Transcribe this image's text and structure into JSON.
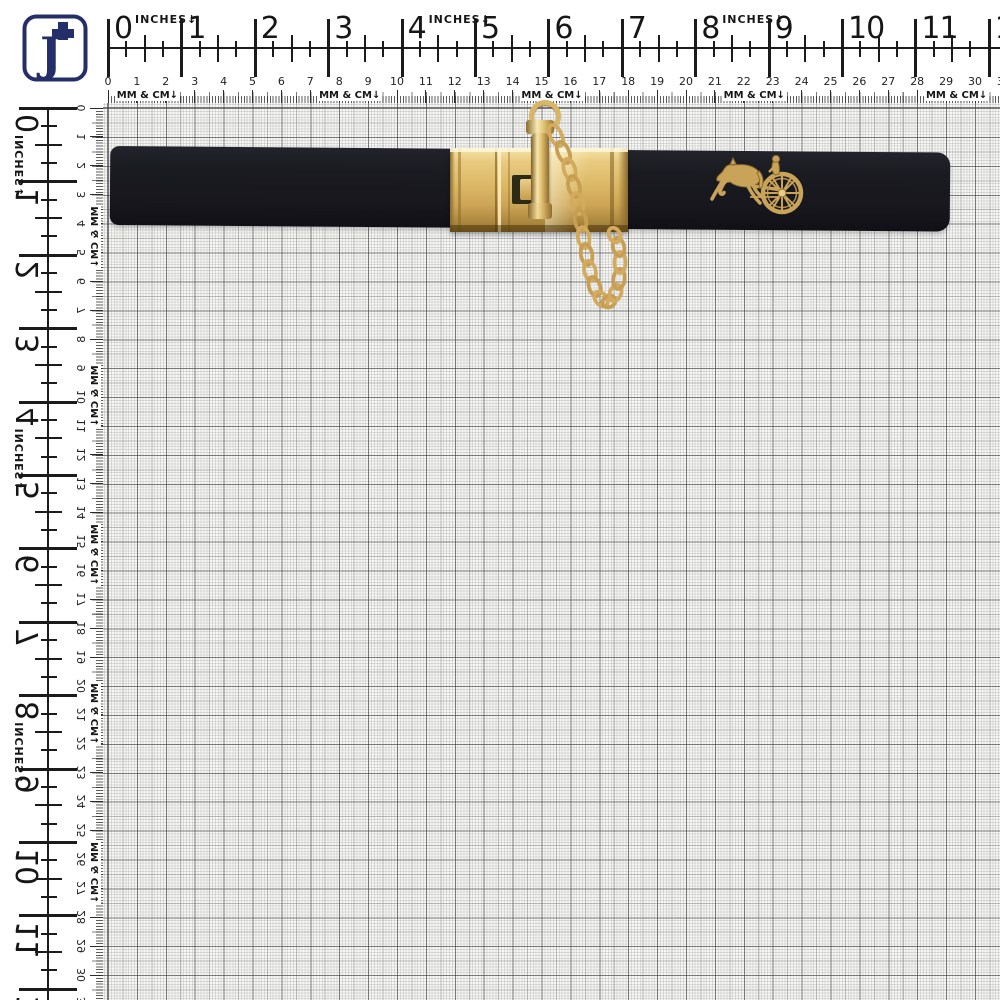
{
  "window": {
    "width": 1000,
    "height": 1000
  },
  "logo": {
    "letter": "J",
    "color": "#242e68"
  },
  "ruler": {
    "inch_unit_label": "INCHES",
    "cm_unit_label": "MM & CM",
    "arrow": "↓",
    "inch_px": 73.4,
    "cm_px": 28.9,
    "inch_labels": [
      "0",
      "1",
      "2",
      "3",
      "4",
      "5",
      "6",
      "7",
      "8",
      "9",
      "10",
      "11",
      "12"
    ],
    "cm_labels": [
      "0",
      "1",
      "2",
      "3",
      "4",
      "5",
      "6",
      "7",
      "8",
      "9",
      "10",
      "11",
      "12",
      "13",
      "14",
      "15",
      "16",
      "17",
      "18",
      "19",
      "20",
      "21",
      "22",
      "23",
      "24",
      "25",
      "26",
      "27",
      "28",
      "29",
      "30",
      "31"
    ],
    "top": {
      "inch_unit_at": [
        0,
        4,
        8
      ],
      "cm_unit_at": [
        0.2,
        7.2,
        14.2,
        21.2,
        28.2
      ]
    },
    "left": {
      "inch_unit_at": [
        0,
        4,
        8
      ],
      "cm_unit_at": [
        3.3,
        8.8,
        14.3,
        19.8,
        25.3
      ]
    }
  },
  "objects": {
    "belt": "black elastic belt strap",
    "buckle": "gold rectangular clasp buckle",
    "pin": "gold toggle pin with top ring",
    "chain": "gold curb chain loop",
    "emblem": "gold horse and carriage emblem",
    "background": "white millimeter/centimeter measuring grid with inch and cm rulers"
  },
  "colors": {
    "gold": "#d4af63",
    "gold_light": "#f1dc9e",
    "gold_dark": "#8a6a2c",
    "belt": "#1b1b22",
    "ruler_ink": "#1b1b1b",
    "grid_line": "#7c7c7c",
    "grid_bg": "#f7f7f5",
    "navy": "#242e68",
    "background": "#ffffff"
  }
}
